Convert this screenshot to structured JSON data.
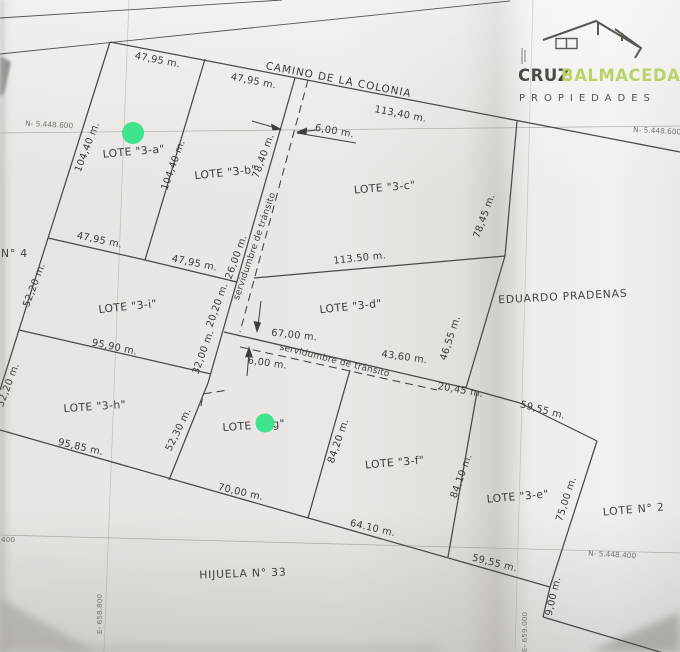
{
  "brand": {
    "name_left": "CRUZ",
    "name_right": "BALMACEDA",
    "tagline": "PROPIEDADES",
    "accent_color": "#b9d36b",
    "text_color": "#4e4b45"
  },
  "plan": {
    "road_label": "CAMINO DE LA COLONIA",
    "neighbor_right": "EDUARDO PRADENAS",
    "neighbor_bottom": "HIJUELA N° 33",
    "neighbor_left": "N° 4",
    "lot2_label": "LOTE N° 2",
    "lots": {
      "a": "LOTE \"3-a\"",
      "b": "LOTE \"3-b\"",
      "c": "LOTE \"3-c\"",
      "d": "LOTE \"3-d\"",
      "e": "LOTE \"3-e\"",
      "f": "LOTE \"3-f\"",
      "g": "LOTE \"3-g\"",
      "h": "LOTE \"3-h\"",
      "i": "LOTE \"3-i\""
    },
    "easements": {
      "vertical": "servidumbre de tránsito",
      "horizontal": "servidumbre de tránsito"
    },
    "dims": {
      "top_a": "47,95 m.",
      "top_b": "47,95 m.",
      "top_c": "113,40 m.",
      "serv_top_width": "6,00 m.",
      "west_a": "104,40 m.",
      "east_a": "104,40 m.",
      "east_b": "78,40 m.",
      "east_b_lower": "26,00 m.",
      "east_i_upper": "20,20 m.",
      "east_i_lower": "32,00 m.",
      "east_c": "78,45 m.",
      "bottom_c": "113.50 m.",
      "top_i_1": "47,95 m.",
      "top_i_2": "47,95 m.",
      "west_i": "52,20 m.",
      "bottom_i": "95,90 m.",
      "serv_west": "67,00 m.",
      "serv_east": "43,60 m.",
      "serv_width": "6,00 m.",
      "east_d": "46,55 m.",
      "ne_1": "20,45 m.",
      "ne_2": "59,55 m.",
      "west_h": "52,20 m.",
      "bottom_h": "95,85 m.",
      "east_h": "52,30 m.",
      "bottom_g": "70,00 m.",
      "east_g": "84,20 m.",
      "east_f": "84,10 m.",
      "bottom_f": "64.10 m.",
      "bottom_e": "59,55 m.",
      "lot2_west": "75,00 m.",
      "lot2_jog": "9,00 m."
    },
    "grid": {
      "n600_left": "N- 5.448.600",
      "n600_right": "N- 5.448.600",
      "n400": "N- 5.448.400",
      "n400_left": "400",
      "e_658800": "E- 658.800",
      "e_659000": "E- 659.000"
    }
  },
  "markers": {
    "color": "#3ee58d"
  }
}
